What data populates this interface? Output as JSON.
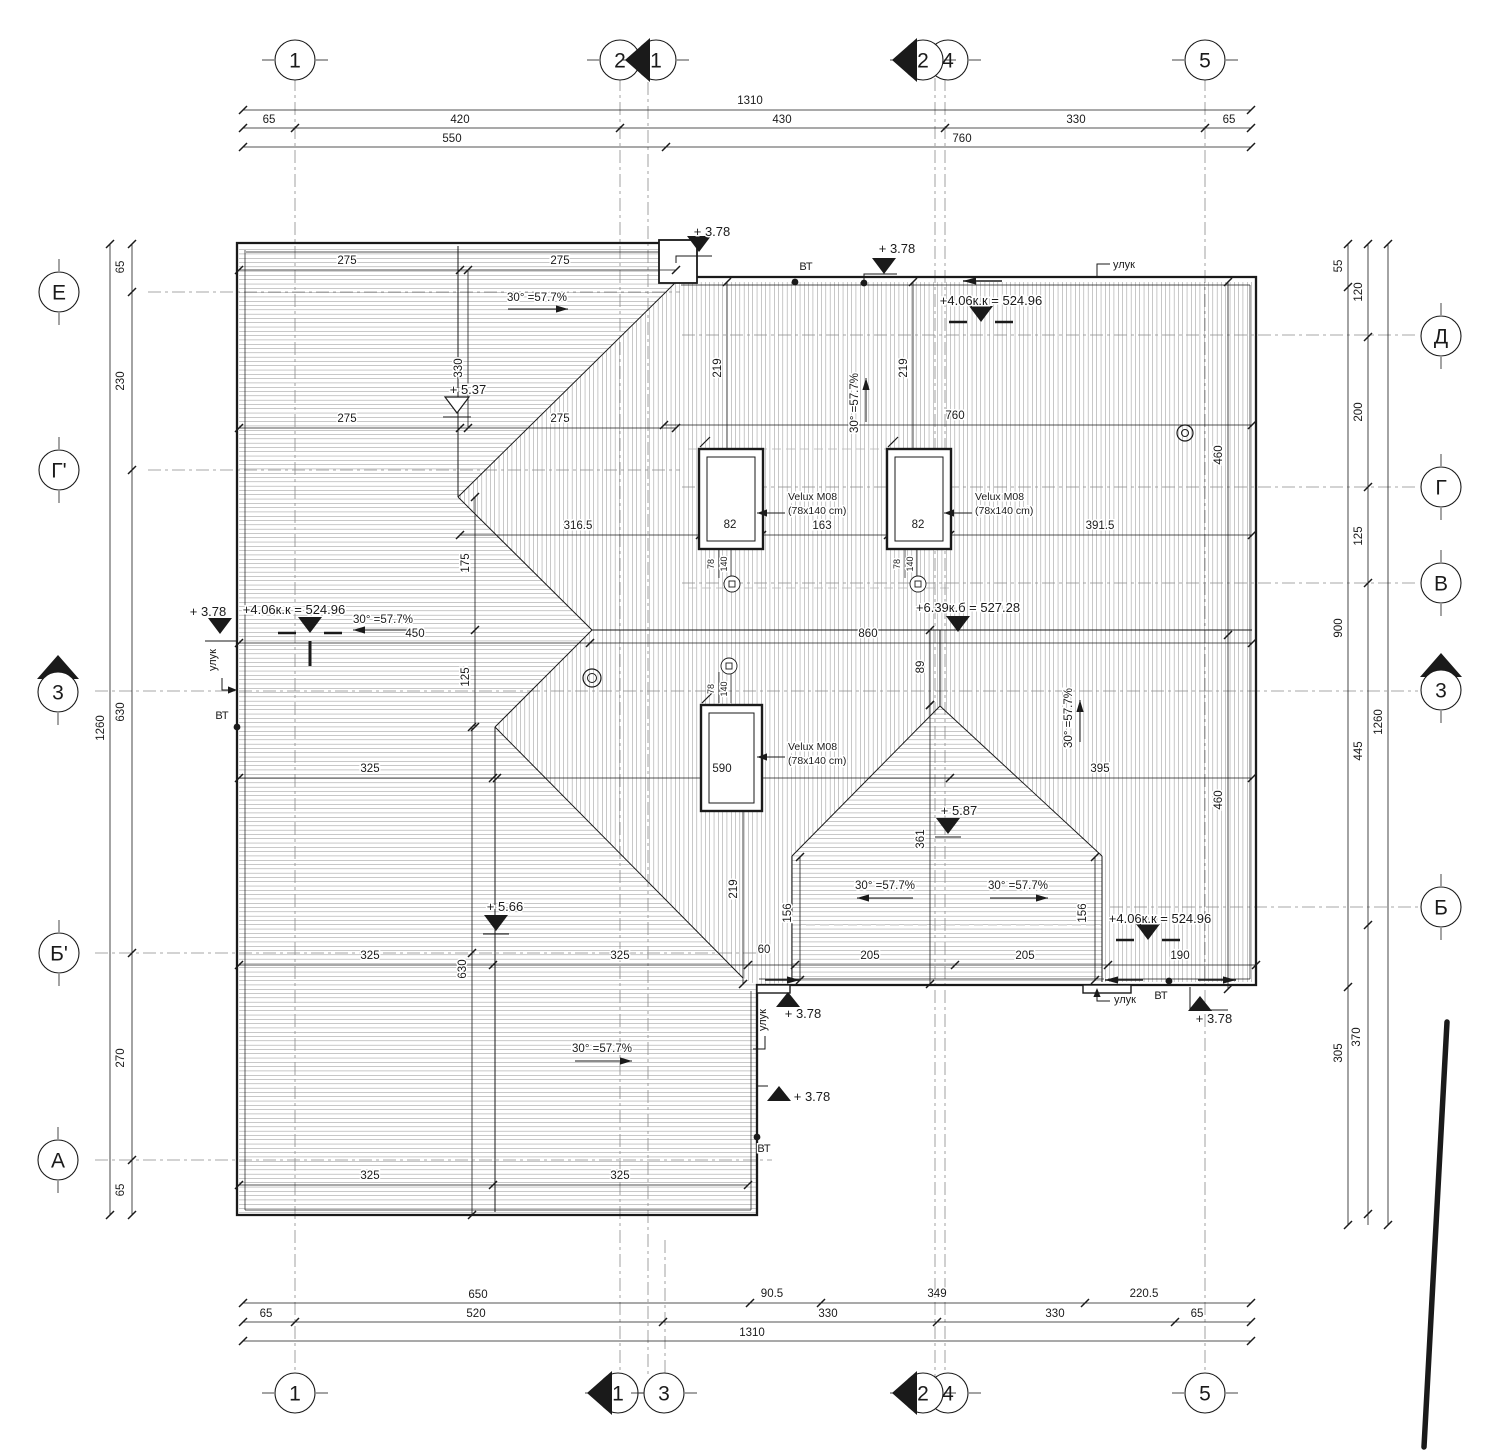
{
  "sheet": {
    "bg": "#ffffff",
    "ink": "#1a1a1a",
    "grid_color": "#8a8a8a",
    "hatch_color": "#4f4f4f"
  },
  "grid_bubbles": [
    {
      "label": "1",
      "x": 295,
      "y": 60,
      "axis": "v"
    },
    {
      "label": "2",
      "x": 620,
      "y": 60,
      "axis": "v"
    },
    {
      "label": "1",
      "x": 656,
      "y": 60,
      "axis": "v",
      "section": "left"
    },
    {
      "label": "4",
      "x": 948,
      "y": 60,
      "axis": "v"
    },
    {
      "label": "2",
      "x": 923,
      "y": 60,
      "axis": "v",
      "section": "left"
    },
    {
      "label": "5",
      "x": 1205,
      "y": 60,
      "axis": "v"
    },
    {
      "label": "1",
      "x": 295,
      "y": 1393,
      "axis": "v"
    },
    {
      "label": "1",
      "x": 618,
      "y": 1393,
      "axis": "v",
      "section": "left"
    },
    {
      "label": "3",
      "x": 664,
      "y": 1393,
      "axis": "v"
    },
    {
      "label": "4",
      "x": 948,
      "y": 1393,
      "axis": "v"
    },
    {
      "label": "2",
      "x": 923,
      "y": 1393,
      "axis": "v",
      "section": "left"
    },
    {
      "label": "5",
      "x": 1205,
      "y": 1393,
      "axis": "v"
    },
    {
      "label": "Е",
      "x": 59,
      "y": 292,
      "axis": "h"
    },
    {
      "label": "Г'",
      "x": 59,
      "y": 470,
      "axis": "h"
    },
    {
      "label": "3",
      "x": 58,
      "y": 692,
      "axis": "h",
      "section": "up"
    },
    {
      "label": "Б'",
      "x": 59,
      "y": 953,
      "axis": "h"
    },
    {
      "label": "А",
      "x": 58,
      "y": 1160,
      "axis": "h"
    },
    {
      "label": "Д",
      "x": 1441,
      "y": 336,
      "axis": "h"
    },
    {
      "label": "Г",
      "x": 1441,
      "y": 487,
      "axis": "h"
    },
    {
      "label": "В",
      "x": 1441,
      "y": 583,
      "axis": "h"
    },
    {
      "label": "3",
      "x": 1441,
      "y": 690,
      "axis": "h",
      "section": "up"
    },
    {
      "label": "Б",
      "x": 1441,
      "y": 907,
      "axis": "h"
    }
  ],
  "dim_labels": [
    {
      "t": "1310",
      "x": 750,
      "y": 104
    },
    {
      "t": "65",
      "x": 269,
      "y": 123
    },
    {
      "t": "420",
      "x": 460,
      "y": 123
    },
    {
      "t": "430",
      "x": 782,
      "y": 123
    },
    {
      "t": "330",
      "x": 1076,
      "y": 123
    },
    {
      "t": "65",
      "x": 1229,
      "y": 123
    },
    {
      "t": "550",
      "x": 452,
      "y": 142
    },
    {
      "t": "760",
      "x": 962,
      "y": 142
    },
    {
      "t": "650",
      "x": 478,
      "y": 1298
    },
    {
      "t": "90.5",
      "x": 772,
      "y": 1297
    },
    {
      "t": "349",
      "x": 937,
      "y": 1297
    },
    {
      "t": "220.5",
      "x": 1144,
      "y": 1297
    },
    {
      "t": "65",
      "x": 266,
      "y": 1317
    },
    {
      "t": "520",
      "x": 476,
      "y": 1317
    },
    {
      "t": "330",
      "x": 828,
      "y": 1317
    },
    {
      "t": "330",
      "x": 1055,
      "y": 1317
    },
    {
      "t": "65",
      "x": 1197,
      "y": 1317
    },
    {
      "t": "1310",
      "x": 752,
      "y": 1336
    },
    {
      "t": "65",
      "x": 124,
      "y": 267,
      "r": 1
    },
    {
      "t": "230",
      "x": 124,
      "y": 381,
      "r": 1
    },
    {
      "t": "1260",
      "x": 104,
      "y": 728,
      "r": 1
    },
    {
      "t": "630",
      "x": 124,
      "y": 712,
      "r": 1
    },
    {
      "t": "270",
      "x": 124,
      "y": 1058,
      "r": 1
    },
    {
      "t": "65",
      "x": 124,
      "y": 1190,
      "r": 1
    },
    {
      "t": "55",
      "x": 1342,
      "y": 266,
      "r": 1
    },
    {
      "t": "120",
      "x": 1362,
      "y": 292,
      "r": 1
    },
    {
      "t": "200",
      "x": 1362,
      "y": 412,
      "r": 1
    },
    {
      "t": "125",
      "x": 1362,
      "y": 536,
      "r": 1
    },
    {
      "t": "900",
      "x": 1342,
      "y": 628,
      "r": 1
    },
    {
      "t": "445",
      "x": 1362,
      "y": 751,
      "r": 1
    },
    {
      "t": "1260",
      "x": 1382,
      "y": 722,
      "r": 1
    },
    {
      "t": "370",
      "x": 1360,
      "y": 1037,
      "r": 1
    },
    {
      "t": "305",
      "x": 1342,
      "y": 1053,
      "r": 1
    },
    {
      "t": "275",
      "x": 347,
      "y": 264
    },
    {
      "t": "275",
      "x": 560,
      "y": 264
    },
    {
      "t": "275",
      "x": 347,
      "y": 422
    },
    {
      "t": "275",
      "x": 560,
      "y": 422
    },
    {
      "t": "330",
      "x": 462,
      "y": 368,
      "r": 1
    },
    {
      "t": "219",
      "x": 721,
      "y": 368,
      "r": 1
    },
    {
      "t": "219",
      "x": 907,
      "y": 368,
      "r": 1
    },
    {
      "t": "760",
      "x": 955,
      "y": 419
    },
    {
      "t": "460",
      "x": 1222,
      "y": 455,
      "r": 1
    },
    {
      "t": "460",
      "x": 1222,
      "y": 800,
      "r": 1
    },
    {
      "t": "316.5",
      "x": 578,
      "y": 529
    },
    {
      "t": "82",
      "x": 730,
      "y": 528
    },
    {
      "t": "163",
      "x": 822,
      "y": 529
    },
    {
      "t": "82",
      "x": 918,
      "y": 528
    },
    {
      "t": "391.5",
      "x": 1100,
      "y": 529
    },
    {
      "t": "175",
      "x": 469,
      "y": 563,
      "r": 1
    },
    {
      "t": "125",
      "x": 469,
      "y": 677,
      "r": 1
    },
    {
      "t": "450",
      "x": 415,
      "y": 637
    },
    {
      "t": "860",
      "x": 868,
      "y": 637
    },
    {
      "t": "89",
      "x": 924,
      "y": 667,
      "r": 1
    },
    {
      "t": "325",
      "x": 370,
      "y": 772
    },
    {
      "t": "590",
      "x": 722,
      "y": 772
    },
    {
      "t": "395",
      "x": 1100,
      "y": 772
    },
    {
      "t": "361",
      "x": 924,
      "y": 839,
      "r": 1
    },
    {
      "t": "219",
      "x": 737,
      "y": 889,
      "r": 1
    },
    {
      "t": "156",
      "x": 791,
      "y": 913,
      "r": 1
    },
    {
      "t": "156",
      "x": 1086,
      "y": 913,
      "r": 1
    },
    {
      "t": "325",
      "x": 370,
      "y": 959
    },
    {
      "t": "325",
      "x": 620,
      "y": 959
    },
    {
      "t": "60",
      "x": 764,
      "y": 953
    },
    {
      "t": "205",
      "x": 870,
      "y": 959
    },
    {
      "t": "205",
      "x": 1025,
      "y": 959
    },
    {
      "t": "190",
      "x": 1180,
      "y": 959
    },
    {
      "t": "630",
      "x": 466,
      "y": 969,
      "r": 1
    },
    {
      "t": "325",
      "x": 370,
      "y": 1179
    },
    {
      "t": "325",
      "x": 620,
      "y": 1179
    },
    {
      "t": "78",
      "x": 714,
      "y": 564,
      "r": 1,
      "s": 9
    },
    {
      "t": "140",
      "x": 727,
      "y": 564,
      "r": 1,
      "s": 9
    },
    {
      "t": "78",
      "x": 900,
      "y": 564,
      "r": 1,
      "s": 9
    },
    {
      "t": "140",
      "x": 913,
      "y": 564,
      "r": 1,
      "s": 9
    },
    {
      "t": "78",
      "x": 714,
      "y": 689,
      "r": 1,
      "s": 9
    },
    {
      "t": "140",
      "x": 727,
      "y": 689,
      "r": 1,
      "s": 9
    }
  ],
  "slope_labels": [
    {
      "t": "30° =57.7%",
      "x": 537,
      "y": 301,
      "rot": 0,
      "line": [
        508,
        309,
        568,
        309
      ]
    },
    {
      "t": "30° =57.7%",
      "x": 383,
      "y": 623,
      "rot": 0,
      "line": [
        415,
        630,
        353,
        630
      ]
    },
    {
      "t": "30° =57.7%",
      "x": 858,
      "y": 403,
      "rot": -90,
      "line": [
        866,
        422,
        866,
        378
      ]
    },
    {
      "t": "30° =57.7%",
      "x": 1072,
      "y": 718,
      "rot": -90,
      "line": [
        1080,
        742,
        1080,
        700
      ]
    },
    {
      "t": "30° =57.7%",
      "x": 885,
      "y": 889,
      "rot": 0,
      "line": [
        913,
        898,
        857,
        898
      ]
    },
    {
      "t": "30° =57.7%",
      "x": 1018,
      "y": 889,
      "rot": 0,
      "line": [
        990,
        898,
        1048,
        898
      ]
    },
    {
      "t": "30° =57.7%",
      "x": 602,
      "y": 1052,
      "rot": 0,
      "line": [
        575,
        1061,
        632,
        1061
      ]
    }
  ],
  "elevation_marks": [
    {
      "t": "+ 3.78",
      "x": 712,
      "y": 236,
      "ax": 699,
      "ay": 252,
      "dir": "down",
      "style": "filled"
    },
    {
      "t": "+ 3.78",
      "x": 897,
      "y": 253,
      "ax": 884,
      "ay": 274,
      "dir": "down",
      "style": "filled"
    },
    {
      "t": "+4.06к.к = 524.96",
      "x": 991,
      "y": 305,
      "ax": 981,
      "ay": 322,
      "dir": "down",
      "style": "bar"
    },
    {
      "t": "+ 3.78",
      "x": 208,
      "y": 616,
      "ax": 220,
      "ay": 634,
      "dir": "down",
      "style": "filled"
    },
    {
      "t": "+4.06к.к = 524.96",
      "x": 294,
      "y": 614,
      "ax": 310,
      "ay": 633,
      "dir": "down",
      "style": "bar2"
    },
    {
      "t": "+6.39к.б = 527.28",
      "x": 968,
      "y": 612,
      "ax": 958,
      "ay": 632,
      "dir": "down",
      "style": "filled"
    },
    {
      "t": "+ 5.37",
      "x": 468,
      "y": 394,
      "ax": 457,
      "ay": 413,
      "dir": "down",
      "style": "open"
    },
    {
      "t": "+ 5.66",
      "x": 505,
      "y": 911,
      "ax": 496,
      "ay": 931,
      "dir": "down",
      "style": "filled_u"
    },
    {
      "t": "+ 5.87",
      "x": 959,
      "y": 815,
      "ax": 948,
      "ay": 834,
      "dir": "down",
      "style": "filled_u"
    },
    {
      "t": "+4.06к.к = 524.96",
      "x": 1160,
      "y": 923,
      "ax": 1148,
      "ay": 940,
      "dir": "down",
      "style": "bar"
    },
    {
      "t": "+ 3.78",
      "x": 803,
      "y": 1018,
      "ax": 788,
      "ay": 992,
      "dir": "up",
      "style": "filled"
    },
    {
      "t": "+ 3.78",
      "x": 812,
      "y": 1101,
      "ax": 779,
      "ay": 1086,
      "dir": "up",
      "style": "filled"
    },
    {
      "t": "+ 3.78",
      "x": 1214,
      "y": 1023,
      "ax": 1200,
      "ay": 996,
      "dir": "up",
      "style": "filled"
    }
  ],
  "labels": [
    {
      "t": "улук",
      "x": 1113,
      "y": 268,
      "anchor": "start"
    },
    {
      "t": "ВТ",
      "x": 806,
      "y": 270
    },
    {
      "t": "улук",
      "x": 216,
      "y": 660,
      "r": 1
    },
    {
      "t": "ВТ",
      "x": 222,
      "y": 719
    },
    {
      "t": "улук",
      "x": 766,
      "y": 1020,
      "r": 1
    },
    {
      "t": "ВТ",
      "x": 764,
      "y": 1152
    },
    {
      "t": "улук",
      "x": 1114,
      "y": 1003,
      "anchor": "start"
    },
    {
      "t": "ВТ",
      "x": 1161,
      "y": 999
    },
    {
      "t": "Velux M08",
      "x": 788,
      "y": 500,
      "anchor": "start",
      "s": 10.5
    },
    {
      "t": "(78x140 cm)",
      "x": 788,
      "y": 514,
      "anchor": "start",
      "s": 10.5
    },
    {
      "t": "Velux M08",
      "x": 975,
      "y": 500,
      "anchor": "start",
      "s": 10.5
    },
    {
      "t": "(78x140 cm)",
      "x": 975,
      "y": 514,
      "anchor": "start",
      "s": 10.5
    },
    {
      "t": "Velux M08",
      "x": 788,
      "y": 750,
      "anchor": "start",
      "s": 10.5
    },
    {
      "t": "(78x140 cm)",
      "x": 788,
      "y": 764,
      "anchor": "start",
      "s": 10.5
    }
  ]
}
